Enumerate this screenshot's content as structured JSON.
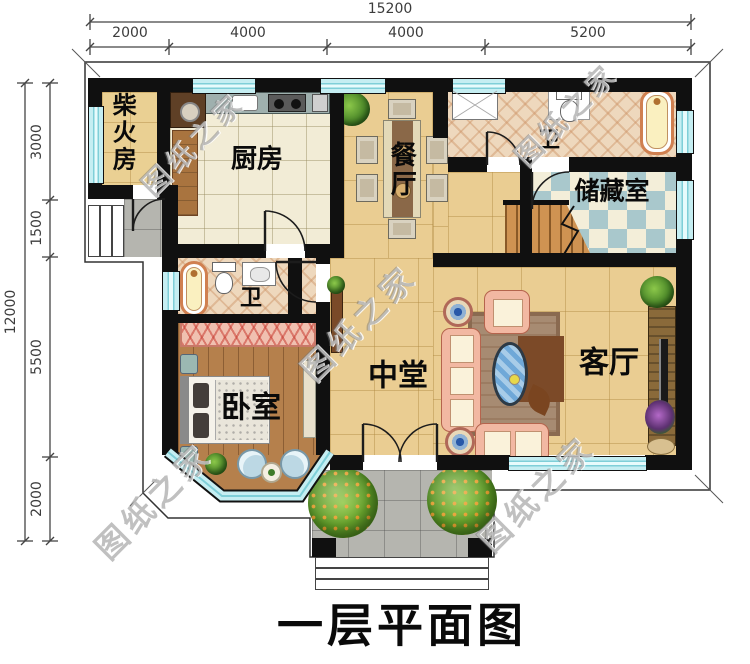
{
  "title": {
    "text": "一层平面图"
  },
  "watermark": {
    "text": "图纸之家"
  },
  "dimensions": {
    "top": {
      "total": "15200",
      "segments": [
        "2000",
        "4000",
        "4000",
        "5200"
      ]
    },
    "left": {
      "total": "12000",
      "segments": [
        "3000",
        "1500",
        "5500",
        "2000"
      ]
    }
  },
  "rooms": {
    "firewood": "柴火房",
    "kitchen": "厨房",
    "dining": "餐厅",
    "bath_top": "卫",
    "storage": "储藏室",
    "bath_left": "卫",
    "hall": "中堂",
    "living": "客厅",
    "bedroom": "卧室"
  },
  "colors": {
    "wall": "#101010",
    "window": "#c5eef2",
    "floor_tile": "#eacd92",
    "kitchen_floor": "#f2ecd6",
    "wood_floor": "#b5804c",
    "bath_tile": "#eed8bd",
    "storage_checker": "#a9c8cc",
    "porch": "#b5b5af",
    "stairs": "#cf9352",
    "greenery": "#5da028",
    "sofa": "#f2b8a2"
  }
}
